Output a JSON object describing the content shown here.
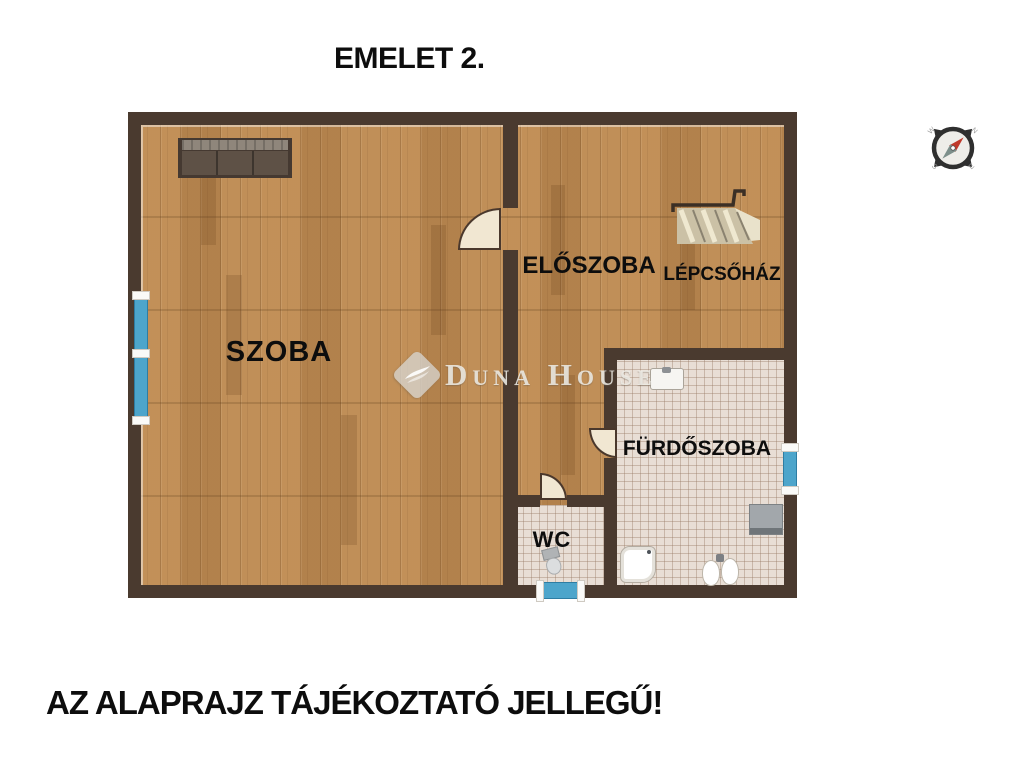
{
  "title": "EMELET 2.",
  "plan": {
    "rooms": {
      "szoba": {
        "label": "SZOBA"
      },
      "eloszoba": {
        "label": "ELŐSZOBA"
      },
      "lepcsohaz": {
        "label": "LÉPCSŐHÁZ"
      },
      "furdoszoba": {
        "label": "FÜRDŐSZOBA"
      },
      "wc": {
        "label": "WC"
      }
    },
    "furniture_icons": [
      "sofa-icon",
      "staircase-icon",
      "washbasin-icon",
      "shower-tray-icon",
      "toilet-icon",
      "bidet-icon",
      "washing-machine-icon",
      "wc-toilet-icon"
    ],
    "window_count": 3,
    "door_count": 3
  },
  "compass": {
    "n": "N",
    "e": "E",
    "s": "S",
    "w": "W"
  },
  "watermark": {
    "brand": "Duna House"
  },
  "disclaimer": "AZ ALAPRAJZ TÁJÉKOZTATÓ JELLEGŰ!",
  "colors": {
    "wall": "#4a3a2f",
    "wood_floor": "#bd8a52",
    "tile_floor": "#e8ded5",
    "window": "#4da5cb",
    "door_leaf": "#f1e7d2",
    "compass_needle_north": "#c0392b",
    "compass_needle_south": "#7d8f8b",
    "text": "#0d0d0d",
    "watermark": "#d6d3ce"
  }
}
